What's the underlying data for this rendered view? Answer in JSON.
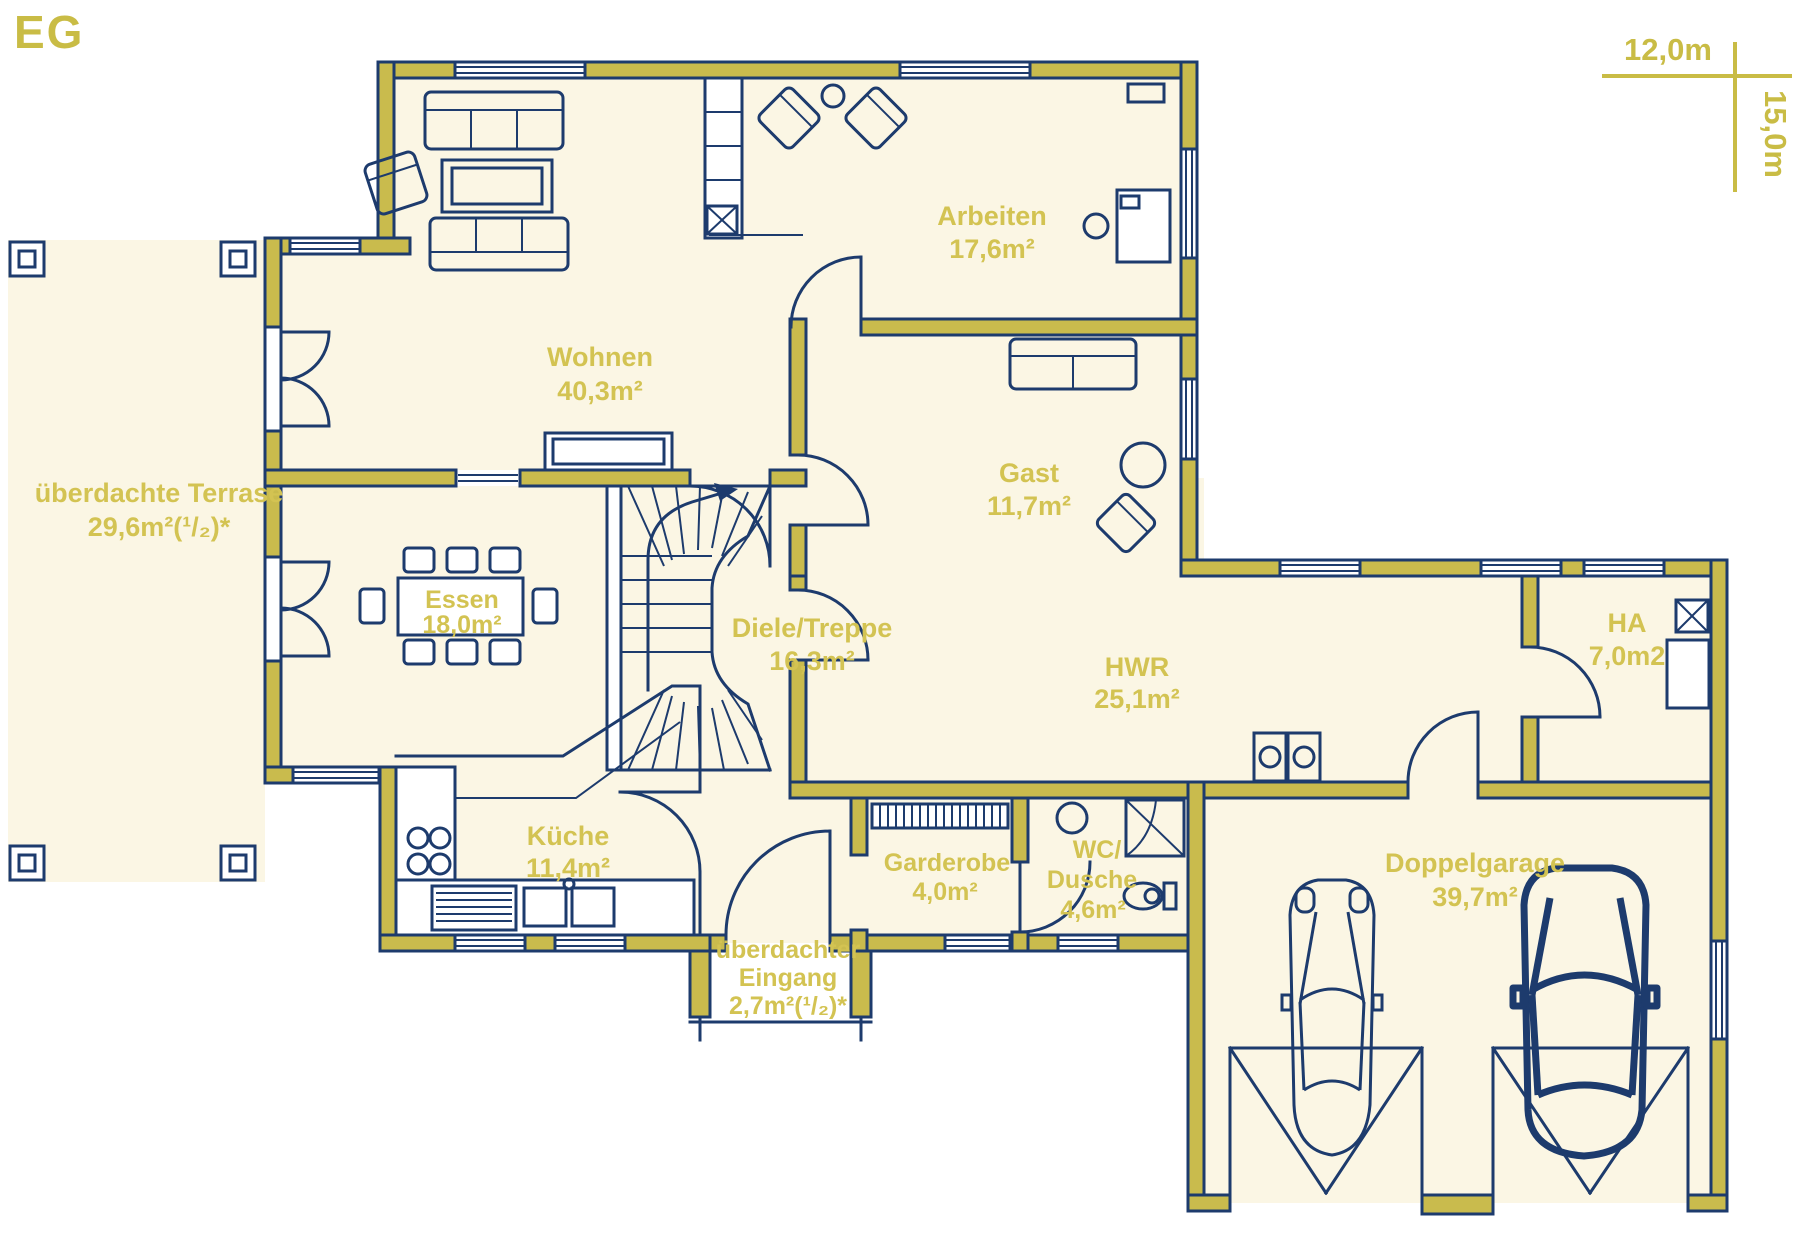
{
  "plan": {
    "title": "EG"
  },
  "scale": {
    "width_label": "12,0m",
    "height_label": "15,0m"
  },
  "rooms": {
    "terrasse": {
      "name": "überdachte Terrase",
      "area": "29,6m²(¹/₂)*"
    },
    "wohnen": {
      "name": "Wohnen",
      "area": "40,3m²"
    },
    "arbeiten": {
      "name": "Arbeiten",
      "area": "17,6m²"
    },
    "gast": {
      "name": "Gast",
      "area": "11,7m²"
    },
    "essen": {
      "name": "Essen",
      "area": "18,0m²"
    },
    "diele": {
      "name": "Diele/Treppe",
      "area": "16,3m²"
    },
    "hwr": {
      "name": "HWR",
      "area": "25,1m²"
    },
    "ha": {
      "name": "HA",
      "area": "7,0m2"
    },
    "kueche": {
      "name": "Küche",
      "area": "11,4m²"
    },
    "garderobe": {
      "name": "Garderobe",
      "area": "4,0m²"
    },
    "wc": {
      "name_line1": "WC/",
      "name_line2": "Dusche",
      "area": "4,6m²"
    },
    "garage": {
      "name": "Doppelgarage",
      "area": "39,7m²"
    },
    "eingang": {
      "name_line1": "überdachter",
      "name_line2": "Eingang",
      "area": "2,7m²(¹/₂)*"
    }
  },
  "colors": {
    "navy": "#1d3b6d",
    "wall_olive": "#c9bb4d",
    "room_cream": "#fbf6e4",
    "label_olive": "#d3c352",
    "accent_olive": "#c9bc45"
  }
}
